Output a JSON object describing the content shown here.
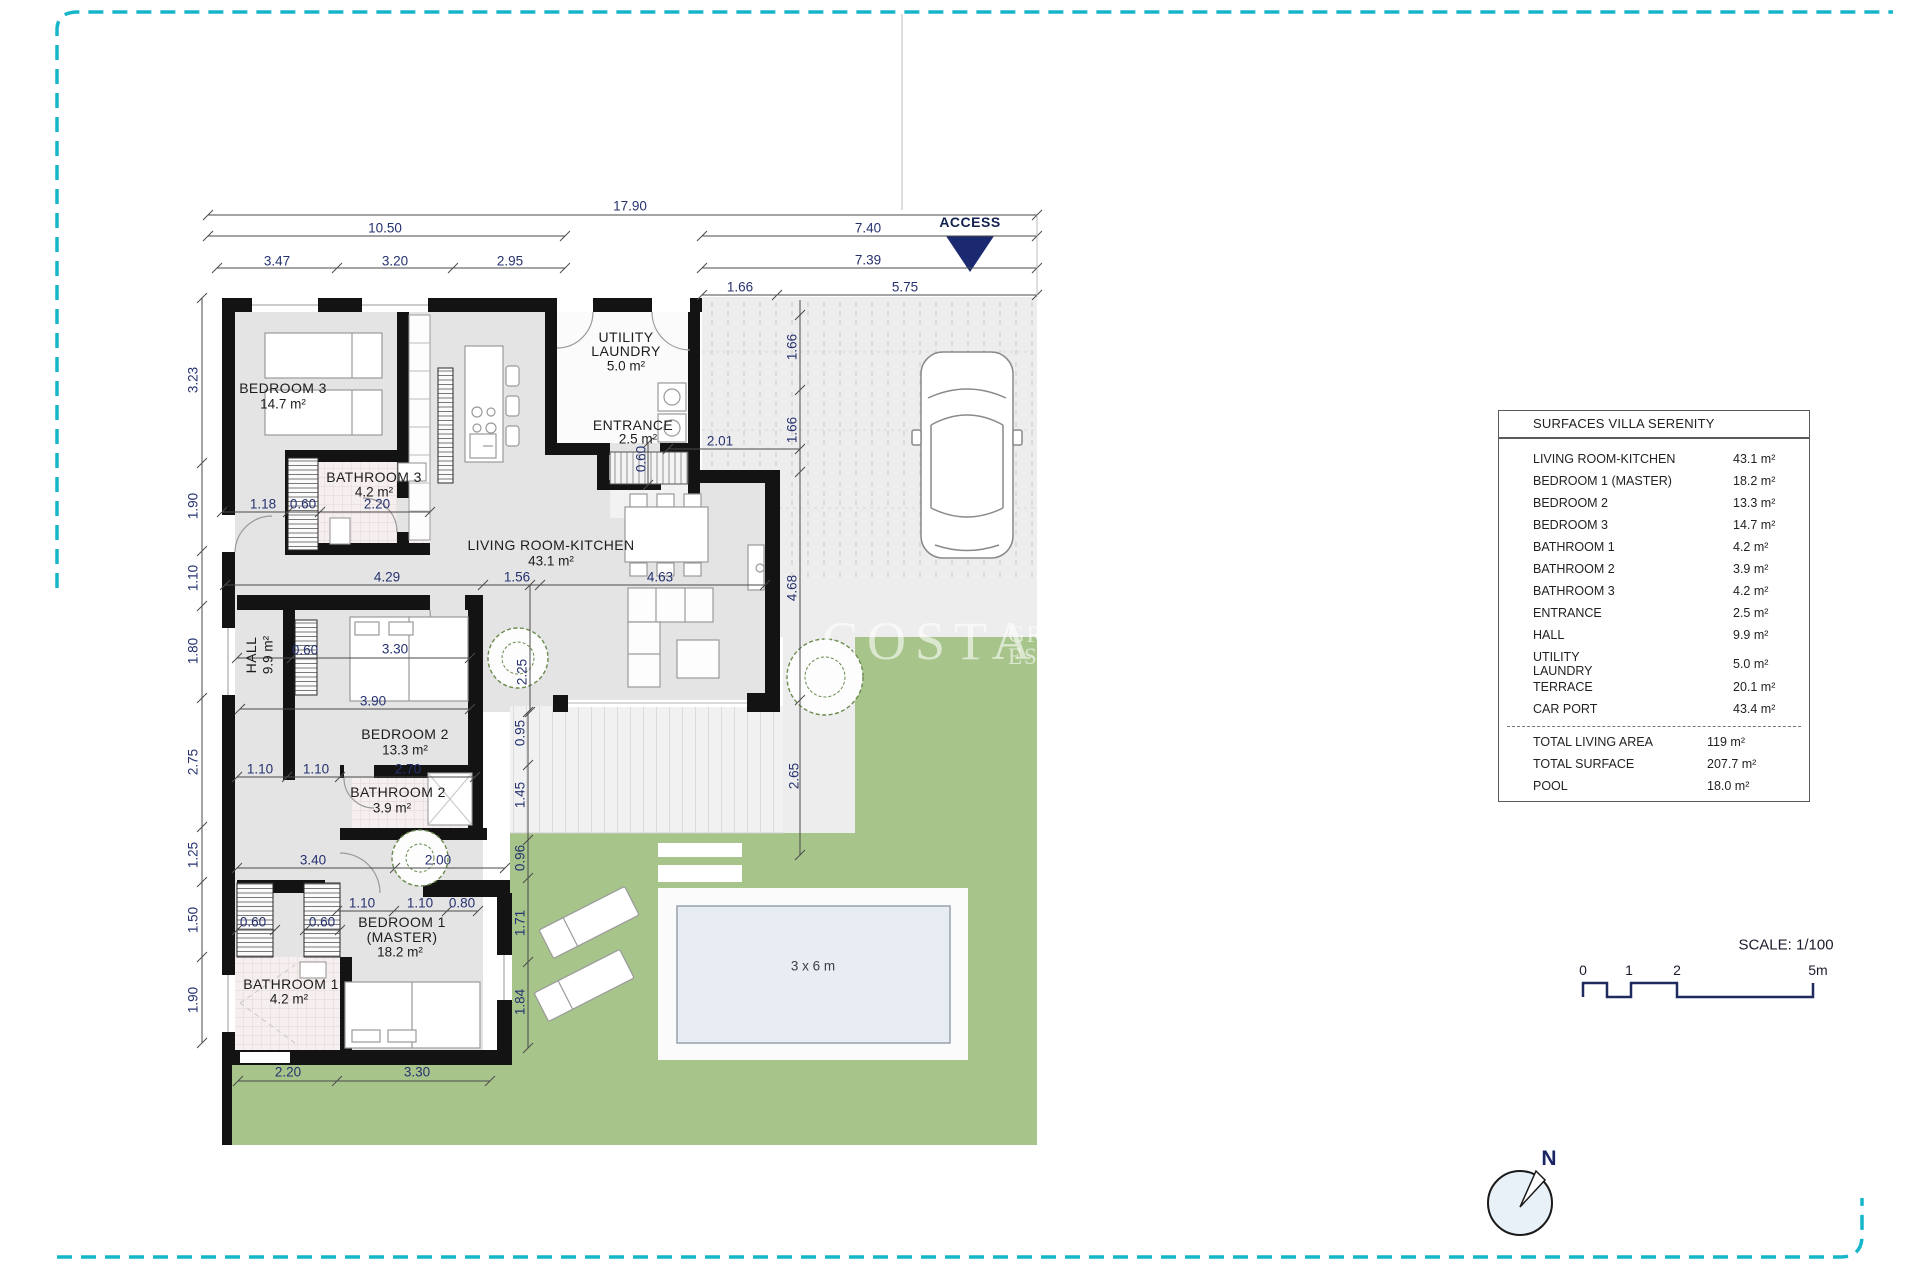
{
  "page": {
    "bg": "#ffffff",
    "border_color": "#16b6ca"
  },
  "access": {
    "label": "ACCESS",
    "triangle_color": "#1b2a70"
  },
  "watermark": {
    "word": "COSTA",
    "small_top": "GR",
    "small_bottom": "EST"
  },
  "pool": {
    "label": "3 x 6 m"
  },
  "compass": {
    "label": "N"
  },
  "scalebar": {
    "title": "SCALE: 1/100",
    "ticks": [
      {
        "t": "0",
        "x": 1583,
        "y": 970
      },
      {
        "t": "1",
        "x": 1629,
        "y": 970
      },
      {
        "t": "2",
        "x": 1677,
        "y": 970
      },
      {
        "t": "5m",
        "x": 1818,
        "y": 970
      }
    ]
  },
  "surfaces_table": {
    "title": "SURFACES VILLA SERENITY",
    "rows": [
      {
        "label": "LIVING ROOM-KITCHEN",
        "value": "43.1 m²"
      },
      {
        "label": "BEDROOM 1 (MASTER)",
        "value": "18.2 m²"
      },
      {
        "label": "BEDROOM 2",
        "value": "13.3 m²"
      },
      {
        "label": "BEDROOM 3",
        "value": "14.7 m²"
      },
      {
        "label": "BATHROOM 1",
        "value": "4.2 m²"
      },
      {
        "label": "BATHROOM 2",
        "value": "3.9 m²"
      },
      {
        "label": "BATHROOM 3",
        "value": "4.2 m²"
      },
      {
        "label": "ENTRANCE",
        "value": "2.5 m²"
      },
      {
        "label": "HALL",
        "value": "9.9 m²"
      },
      {
        "label": "UTILITY",
        "label2": "LAUNDRY",
        "value": "5.0 m²"
      },
      {
        "label": "TERRACE",
        "value": "20.1 m²"
      },
      {
        "label": "CAR PORT",
        "value": "43.4 m²"
      }
    ],
    "totals": [
      {
        "label": "TOTAL LIVING AREA",
        "value": "119 m²"
      },
      {
        "label": "TOTAL SURFACE",
        "value": "207.7 m²"
      },
      {
        "label": "POOL",
        "value": "18.0 m²"
      }
    ]
  },
  "plan": {
    "labels": [
      {
        "t": "17.90",
        "x": 630,
        "y": 206,
        "cls": "dim"
      },
      {
        "t": "10.50",
        "x": 385,
        "y": 228,
        "cls": "dim"
      },
      {
        "t": "7.40",
        "x": 868,
        "y": 228,
        "cls": "dim"
      },
      {
        "t": "3.47",
        "x": 277,
        "y": 261,
        "cls": "dim"
      },
      {
        "t": "3.20",
        "x": 395,
        "y": 261,
        "cls": "dim"
      },
      {
        "t": "2.95",
        "x": 510,
        "y": 261,
        "cls": "dim"
      },
      {
        "t": "7.39",
        "x": 868,
        "y": 260,
        "cls": "dim"
      },
      {
        "t": "1.66",
        "x": 740,
        "y": 287,
        "cls": "dim"
      },
      {
        "t": "5.75",
        "x": 905,
        "y": 287,
        "cls": "dim"
      },
      {
        "t": "2.01",
        "x": 720,
        "y": 441,
        "cls": "dim"
      },
      {
        "t": "1.18",
        "x": 263,
        "y": 504,
        "cls": "dim"
      },
      {
        "t": "0.60",
        "x": 303,
        "y": 504,
        "cls": "dim"
      },
      {
        "t": "2.20",
        "x": 377,
        "y": 504,
        "cls": "dim"
      },
      {
        "t": "4.29",
        "x": 387,
        "y": 577,
        "cls": "dim"
      },
      {
        "t": "1.56",
        "x": 517,
        "y": 577,
        "cls": "dim"
      },
      {
        "t": "4.63",
        "x": 660,
        "y": 577,
        "cls": "dim"
      },
      {
        "t": "0.60",
        "x": 305,
        "y": 650,
        "cls": "dim"
      },
      {
        "t": "3.30",
        "x": 395,
        "y": 649,
        "cls": "dim"
      },
      {
        "t": "3.90",
        "x": 373,
        "y": 701,
        "cls": "dim"
      },
      {
        "t": "1.10",
        "x": 260,
        "y": 769,
        "cls": "dim"
      },
      {
        "t": "1.10",
        "x": 316,
        "y": 769,
        "cls": "dim"
      },
      {
        "t": "2.70",
        "x": 408,
        "y": 769,
        "cls": "dim"
      },
      {
        "t": "3.40",
        "x": 313,
        "y": 860,
        "cls": "dim"
      },
      {
        "t": "2.00",
        "x": 438,
        "y": 860,
        "cls": "dim"
      },
      {
        "t": "1.10",
        "x": 362,
        "y": 903,
        "cls": "dim"
      },
      {
        "t": "1.10",
        "x": 420,
        "y": 903,
        "cls": "dim"
      },
      {
        "t": "0.80",
        "x": 462,
        "y": 903,
        "cls": "dim"
      },
      {
        "t": "0.60",
        "x": 253,
        "y": 922,
        "cls": "dim"
      },
      {
        "t": "0.60",
        "x": 322,
        "y": 922,
        "cls": "dim"
      },
      {
        "t": "2.20",
        "x": 288,
        "y": 1072,
        "cls": "dim"
      },
      {
        "t": "3.30",
        "x": 417,
        "y": 1072,
        "cls": "dim"
      },
      {
        "t": "3.23",
        "x": 193,
        "y": 380,
        "cls": "dim",
        "rot": 1
      },
      {
        "t": "1.90",
        "x": 193,
        "y": 506,
        "cls": "dim",
        "rot": 1
      },
      {
        "t": "1.10",
        "x": 193,
        "y": 578,
        "cls": "dim",
        "rot": 1
      },
      {
        "t": "1.80",
        "x": 193,
        "y": 651,
        "cls": "dim",
        "rot": 1
      },
      {
        "t": "2.75",
        "x": 193,
        "y": 762,
        "cls": "dim",
        "rot": 1
      },
      {
        "t": "1.25",
        "x": 193,
        "y": 855,
        "cls": "dim",
        "rot": 1
      },
      {
        "t": "1.50",
        "x": 193,
        "y": 920,
        "cls": "dim",
        "rot": 1
      },
      {
        "t": "1.90",
        "x": 193,
        "y": 1000,
        "cls": "dim",
        "rot": 1
      },
      {
        "t": "1.66",
        "x": 792,
        "y": 347,
        "cls": "dim",
        "rot": 1
      },
      {
        "t": "1.66",
        "x": 792,
        "y": 430,
        "cls": "dim",
        "rot": 1
      },
      {
        "t": "4.68",
        "x": 792,
        "y": 588,
        "cls": "dim",
        "rot": 1
      },
      {
        "t": "2.65",
        "x": 794,
        "y": 776,
        "cls": "dim",
        "rot": 1
      },
      {
        "t": "2.25",
        "x": 522,
        "y": 672,
        "cls": "dim",
        "rot": 1
      },
      {
        "t": "0.95",
        "x": 520,
        "y": 733,
        "cls": "dim",
        "rot": 1
      },
      {
        "t": "1.45",
        "x": 520,
        "y": 795,
        "cls": "dim",
        "rot": 1
      },
      {
        "t": "0.96",
        "x": 520,
        "y": 858,
        "cls": "dim",
        "rot": 1
      },
      {
        "t": "1.71",
        "x": 520,
        "y": 923,
        "cls": "dim",
        "rot": 1
      },
      {
        "t": "1.84",
        "x": 520,
        "y": 1002,
        "cls": "dim",
        "rot": 1
      },
      {
        "t": "0.60",
        "x": 641,
        "y": 459,
        "cls": "dim",
        "rot": 1
      },
      {
        "t": "BEDROOM 3",
        "x": 283,
        "y": 388,
        "cls": "room"
      },
      {
        "t": "14.7 m²",
        "x": 283,
        "y": 404,
        "cls": "area"
      },
      {
        "t": "BATHROOM 3",
        "x": 374,
        "y": 477,
        "cls": "room"
      },
      {
        "t": "4.2 m²",
        "x": 374,
        "y": 492,
        "cls": "area"
      },
      {
        "t": "UTILITY",
        "x": 626,
        "y": 337,
        "cls": "room"
      },
      {
        "t": "LAUNDRY",
        "x": 626,
        "y": 351,
        "cls": "room"
      },
      {
        "t": "5.0 m²",
        "x": 626,
        "y": 366,
        "cls": "area"
      },
      {
        "t": "ENTRANCE",
        "x": 633,
        "y": 425,
        "cls": "room"
      },
      {
        "t": "2.5 m²",
        "x": 638,
        "y": 439,
        "cls": "area"
      },
      {
        "t": "LIVING ROOM-KITCHEN",
        "x": 551,
        "y": 545,
        "cls": "room"
      },
      {
        "t": "43.1 m²",
        "x": 551,
        "y": 561,
        "cls": "area"
      },
      {
        "t": "HALL",
        "x": 251,
        "y": 655,
        "cls": "room",
        "rot": 1
      },
      {
        "t": "9.9 m²",
        "x": 268,
        "y": 655,
        "cls": "area",
        "rot": 1
      },
      {
        "t": "BEDROOM 2",
        "x": 405,
        "y": 734,
        "cls": "room"
      },
      {
        "t": "13.3 m²",
        "x": 405,
        "y": 750,
        "cls": "area"
      },
      {
        "t": "BATHROOM 2",
        "x": 398,
        "y": 792,
        "cls": "room"
      },
      {
        "t": "3.9 m²",
        "x": 392,
        "y": 808,
        "cls": "area"
      },
      {
        "t": "BEDROOM 1",
        "x": 402,
        "y": 922,
        "cls": "room"
      },
      {
        "t": "(MASTER)",
        "x": 402,
        "y": 937,
        "cls": "room"
      },
      {
        "t": "18.2 m²",
        "x": 400,
        "y": 952,
        "cls": "area"
      },
      {
        "t": "BATHROOM 1",
        "x": 291,
        "y": 984,
        "cls": "room"
      },
      {
        "t": "4.2 m²",
        "x": 289,
        "y": 999,
        "cls": "area"
      },
      {
        "t": "3 x 6 m",
        "x": 813,
        "y": 966,
        "cls": "pool"
      },
      {
        "t": "ACCESS",
        "x": 970,
        "y": 222,
        "cls": "access"
      }
    ],
    "hlines": [
      {
        "y": 215,
        "x1": 208,
        "x2": 1037,
        "ticks": [
          208,
          1037
        ]
      },
      {
        "y": 236,
        "x1": 208,
        "x2": 565,
        "ticks": [
          208,
          565
        ]
      },
      {
        "y": 236,
        "x1": 702,
        "x2": 1037,
        "ticks": [
          702,
          1037
        ]
      },
      {
        "y": 268,
        "x1": 217,
        "x2": 565,
        "ticks": [
          217,
          337,
          453,
          565
        ]
      },
      {
        "y": 268,
        "x1": 702,
        "x2": 1037,
        "ticks": [
          702,
          1037
        ]
      },
      {
        "y": 295,
        "x1": 702,
        "x2": 1037,
        "ticks": [
          702,
          777,
          1037
        ]
      },
      {
        "y": 449,
        "x1": 668,
        "x2": 800,
        "ticks": [
          668,
          800
        ]
      },
      {
        "y": 512,
        "x1": 222,
        "x2": 430,
        "ticks": [
          222,
          288,
          320,
          430
        ]
      },
      {
        "y": 585,
        "x1": 225,
        "x2": 765,
        "ticks": [
          225,
          483,
          540,
          765
        ]
      },
      {
        "y": 658,
        "x1": 237,
        "x2": 470,
        "ticks": [
          237,
          292,
          470
        ]
      },
      {
        "y": 709,
        "x1": 240,
        "x2": 470,
        "ticks": [
          240,
          470
        ]
      },
      {
        "y": 777,
        "x1": 237,
        "x2": 475,
        "ticks": [
          237,
          287,
          340,
          475
        ]
      },
      {
        "y": 868,
        "x1": 237,
        "x2": 505,
        "ticks": [
          237,
          395,
          505
        ]
      },
      {
        "y": 911,
        "x1": 337,
        "x2": 478,
        "ticks": [
          337,
          394,
          447,
          478
        ]
      },
      {
        "y": 930,
        "x1": 237,
        "x2": 275,
        "ticks": [
          237,
          275
        ]
      },
      {
        "y": 930,
        "x1": 305,
        "x2": 340,
        "ticks": [
          305,
          340
        ]
      },
      {
        "y": 1081,
        "x1": 238,
        "x2": 490,
        "ticks": [
          238,
          337,
          490
        ]
      }
    ],
    "vlines": [
      {
        "x": 202,
        "y1": 298,
        "y2": 1043,
        "ticks": [
          298,
          463,
          551,
          606,
          698,
          827,
          882,
          957,
          1043
        ]
      },
      {
        "x": 800,
        "y1": 300,
        "y2": 855,
        "ticks": [
          315,
          390,
          472,
          700,
          855
        ]
      },
      {
        "x": 530,
        "y1": 585,
        "y2": 712,
        "ticks": [
          585,
          712
        ]
      },
      {
        "x": 528,
        "y1": 712,
        "y2": 1048,
        "ticks": [
          712,
          765,
          840,
          878,
          962,
          1048
        ]
      },
      {
        "x": 648,
        "y1": 443,
        "y2": 485,
        "ticks": [
          443,
          485
        ]
      },
      {
        "x": 902,
        "y1": 14,
        "y2": 210,
        "ticks": [],
        "light": 1
      },
      {
        "x": 1037,
        "y1": 215,
        "y2": 297,
        "ticks": [],
        "light": 1
      }
    ]
  }
}
